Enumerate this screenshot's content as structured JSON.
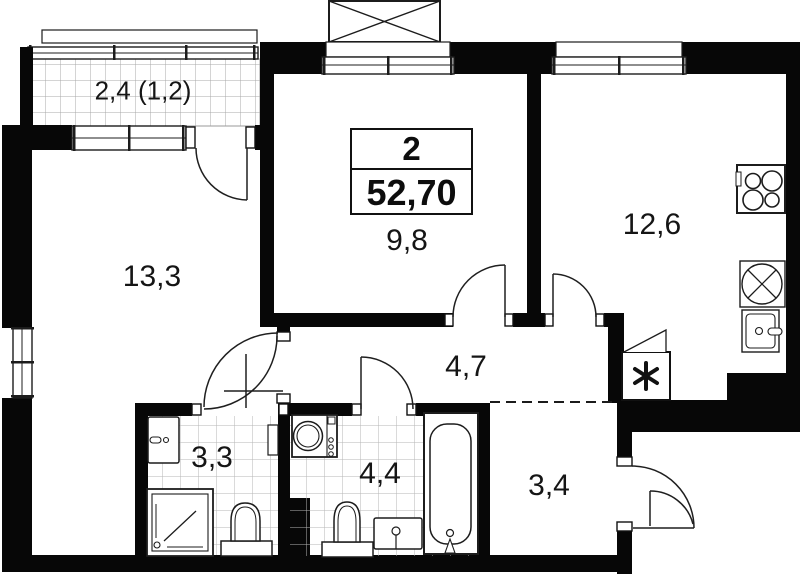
{
  "plan": {
    "badge": {
      "rooms_count": "2",
      "total_area": "52,70"
    },
    "rooms": {
      "balcony": {
        "label": "2,4 (1,2)"
      },
      "living_room": {
        "label": "13,3"
      },
      "bedroom": {
        "label": "9,8"
      },
      "kitchen": {
        "label": "12,6"
      },
      "hallway": {
        "label": "4,7"
      },
      "shower_room": {
        "label": "3,3"
      },
      "bathroom": {
        "label": "4,4"
      },
      "entry_hall": {
        "label": "3,4"
      }
    },
    "fixtures": {
      "kitchen": [
        "stove-icon",
        "kitchen-sink-icon",
        "appliance-icon",
        "vent-shaft-icon"
      ],
      "shower_room": [
        "washbasin-icon",
        "shower-tray-icon",
        "toilet-icon",
        "towel-rail-icon"
      ],
      "bathroom": [
        "washing-machine-icon",
        "toilet-icon",
        "washbasin-icon",
        "bathtub-icon"
      ]
    },
    "colors": {
      "wall": "#070707",
      "line": "#1c1c1c",
      "grid": "#a9a9a9",
      "tile": "#b5b5b5",
      "background": "#ffffff"
    }
  }
}
